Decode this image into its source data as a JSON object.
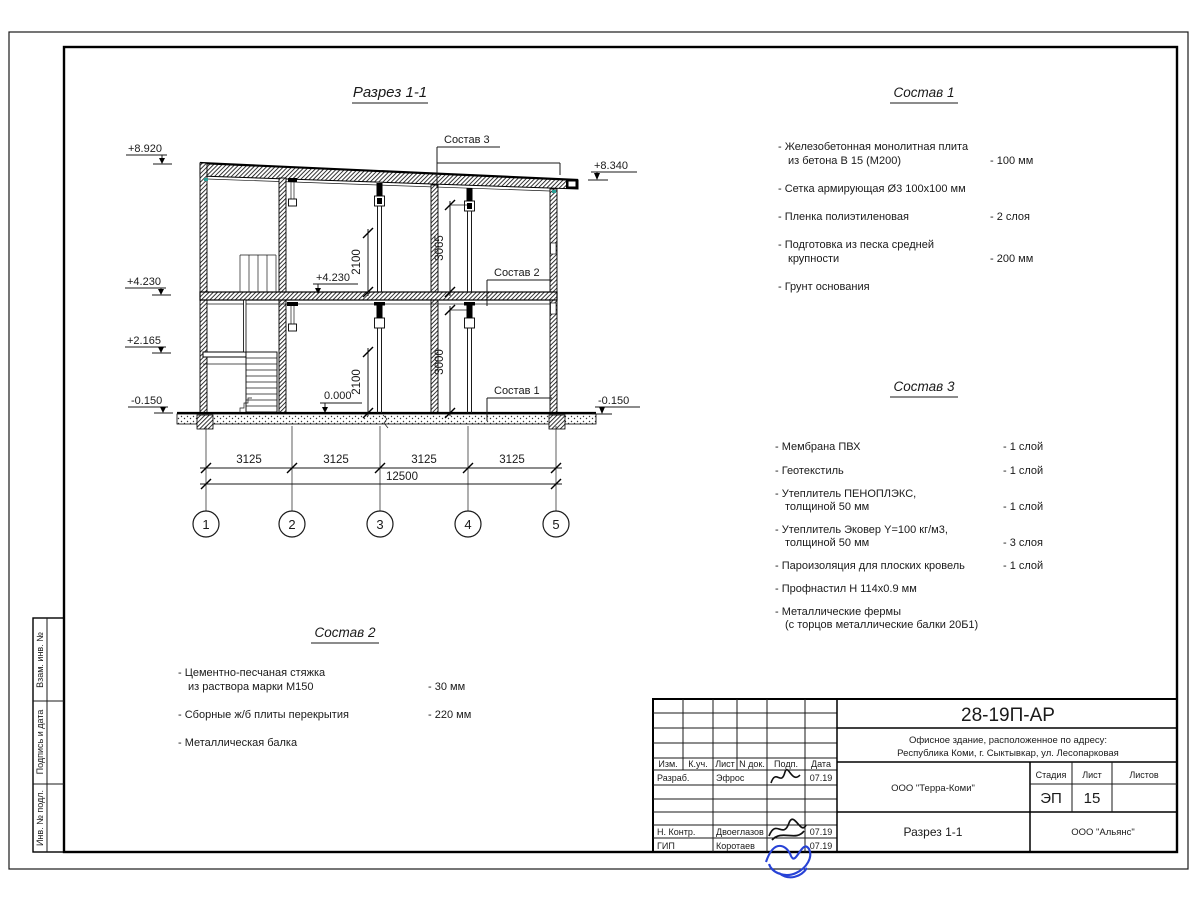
{
  "drawing": {
    "title": "Разрез 1-1",
    "levels_left": [
      "+8.920",
      "+4.230",
      "+2.165",
      "-0.150"
    ],
    "levels_right": [
      "+8.340",
      "-0.150"
    ],
    "level_floor2": "+4.230",
    "level_floor1": "0.000",
    "dim_door2": "2100",
    "dim_h2": "3065",
    "dim_door1": "2100",
    "dim_h1": "3000",
    "dim_spans": [
      "3125",
      "3125",
      "3125",
      "3125"
    ],
    "dim_total": "12500",
    "grids": [
      "1",
      "2",
      "3",
      "4",
      "5"
    ],
    "leaders": [
      "Состав 3",
      "Состав 2",
      "Состав 1"
    ]
  },
  "lists": {
    "s1": {
      "title": "Состав 1",
      "items": [
        {
          "t": "- Железобетонная  монолитная плита",
          "t2": "из бетона В 15 (М200)",
          "v": "- 100 мм"
        },
        {
          "t": "- Сетка армирующая Ø3 100х100 мм"
        },
        {
          "t": "- Пленка полиэтиленовая",
          "v": "-  2 слоя"
        },
        {
          "t": "- Подготовка из песка средней",
          "t2": "крупности",
          "v": "- 200 мм"
        },
        {
          "t": "- Грунт основания"
        }
      ]
    },
    "s2": {
      "title": "Состав 2",
      "items": [
        {
          "t": "- Цементно-песчаная стяжка",
          "t2": "из раствора марки М150",
          "v": "- 30 мм"
        },
        {
          "t": "- Сборные ж/б плиты перекрытия",
          "v": "- 220 мм"
        },
        {
          "t": "- Металлическая балка"
        }
      ]
    },
    "s3": {
      "title": "Состав 3",
      "items": [
        {
          "t": "- Мембрана ПВХ",
          "v": "- 1 слой"
        },
        {
          "t": "- Геотекстиль",
          "v": "- 1 слой"
        },
        {
          "t": "- Утеплитель ПЕНОПЛЭКС,",
          "t2": "толщиной 50 мм",
          "v": "- 1 слой"
        },
        {
          "t": "- Утеплитель Эковер Y=100 кг/м3,",
          "t2": "толщиной 50 мм",
          "v": "- 3 слоя"
        },
        {
          "t": "- Пароизоляция для плоских кровель",
          "v": "- 1 слой"
        },
        {
          "t": "- Профнастил Н 114х0.9 мм"
        },
        {
          "t": "- Металлические фермы",
          "t2": "(с торцов металлические балки 20Б1)"
        }
      ]
    }
  },
  "titleblock": {
    "doc_code": "28-19П-АР",
    "object_line1": "Офисное здание, расположенное по адресу:",
    "object_line2": "Республика Коми, г. Сыктывкар, ул. Лесопарковая",
    "headers": {
      "izm": "Изм.",
      "kuch": "К.уч.",
      "list": "Лист",
      "ndoc": "N док.",
      "podp": "Подп.",
      "data": "Дата",
      "stage": "Стадия",
      "sheet": "Лист",
      "sheets": "Листов"
    },
    "rows": [
      {
        "role": "Разраб.",
        "name": "Эфрос",
        "date": "07.19"
      },
      {
        "role": "Н. Контр.",
        "name": "Двоеглазов",
        "date": "07.19"
      },
      {
        "role": "ГИП",
        "name": "Коротаев",
        "date": "07.19"
      }
    ],
    "org": "ООО \"Терра-Коми\"",
    "stage_value": "ЭП",
    "sheet_value": "15",
    "sheets_value": "",
    "drawing_name": "Разрез 1-1",
    "contractor": "ООО \"Альянс\""
  },
  "strip_labels": [
    "Взам. инв. №",
    "Подпись и дата",
    "Инв. № подл."
  ],
  "colors": {
    "ink": "#1a1a1a",
    "signature_blue": "#2742d6",
    "teal_mark": "#2aa198"
  }
}
